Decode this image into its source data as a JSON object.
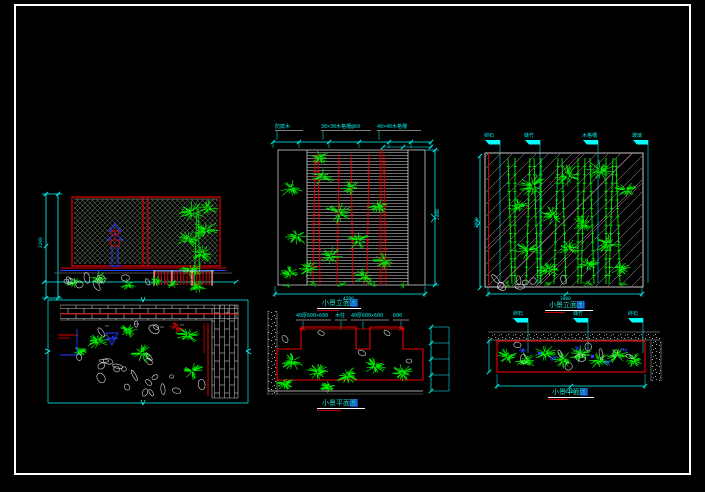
{
  "canvas": {
    "width": 705,
    "height": 492,
    "background": "#000000",
    "frame_color": "#ffffff"
  },
  "palette": {
    "plant_green": "#00ef00",
    "stem_red": "#dd0000",
    "dim_cyan": "#00ffff",
    "accent_blue": "#2a3cff",
    "hatch_gray": "#5c6a57",
    "slat_gray": "#b5b5b5",
    "stone_white": "#dcdcdc",
    "magenta": "#ff5fd2",
    "stipple_gray": "#b0b0b0",
    "title_teal": "#22d9c4"
  },
  "views": [
    {
      "id": "elevation-left",
      "title": "",
      "dim_left": "2200"
    },
    {
      "id": "elevation-middle",
      "title": "小景立面圖",
      "notes": [
        "防腐木",
        "30×30木格柵@60",
        "40×40木格柵"
      ],
      "dim_bottom": "4500",
      "dim_right": "2400"
    },
    {
      "id": "elevation-right",
      "title": "小景立面圖",
      "flags": [
        "卵石",
        "綠竹",
        "木格柵",
        "玻璃"
      ],
      "dim_bottom": "3000",
      "dim_left": "2800"
    },
    {
      "id": "plan-left",
      "title": ""
    },
    {
      "id": "plan-middle",
      "title": "小景平面圖",
      "notes": [
        "40厚600×600",
        "木柱",
        "40厚600×600",
        "600"
      ]
    },
    {
      "id": "plan-right",
      "title": "小景平面圖",
      "flags": [
        "卵石",
        "綠竹",
        "碎石"
      ],
      "dim_bottom": "4200"
    }
  ]
}
